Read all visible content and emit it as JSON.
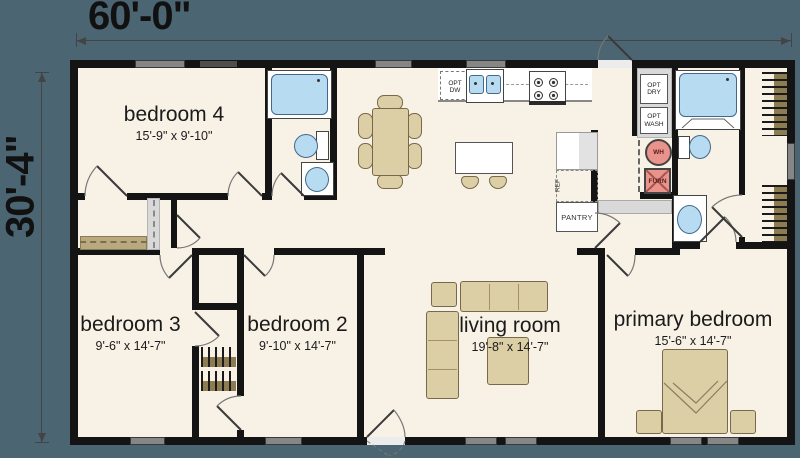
{
  "plan": {
    "width_dim": "60'-0\"",
    "height_dim": "30'-4\""
  },
  "rooms": [
    {
      "name": "bedroom 4",
      "dims": "15'-9\" x 9'-10\""
    },
    {
      "name": "bedroom 3",
      "dims": "9'-6\" x 14'-7\""
    },
    {
      "name": "bedroom 2",
      "dims": "9'-10\" x 14'-7\""
    },
    {
      "name": "living room",
      "dims": "19'-8\" x 14'-7\""
    },
    {
      "name": "primary bedroom",
      "dims": "15'-6\" x 14'-7\""
    }
  ],
  "labels": {
    "opt_dw": "OPT\nDW",
    "opt_dry": "OPT\nDRY",
    "opt_wash": "OPT\nWASH",
    "wh": "WH",
    "furn": "FURN",
    "ref": "REF",
    "pantry": "PANTRY"
  },
  "colors": {
    "background": "#4b6672",
    "floor": "#f8f2e6",
    "wall": "#141414",
    "fixture_blue": "#b7dcf2",
    "furniture_tan": "#ddcfa5",
    "utility_red": "#e9938c",
    "window_gray": "#868686"
  }
}
